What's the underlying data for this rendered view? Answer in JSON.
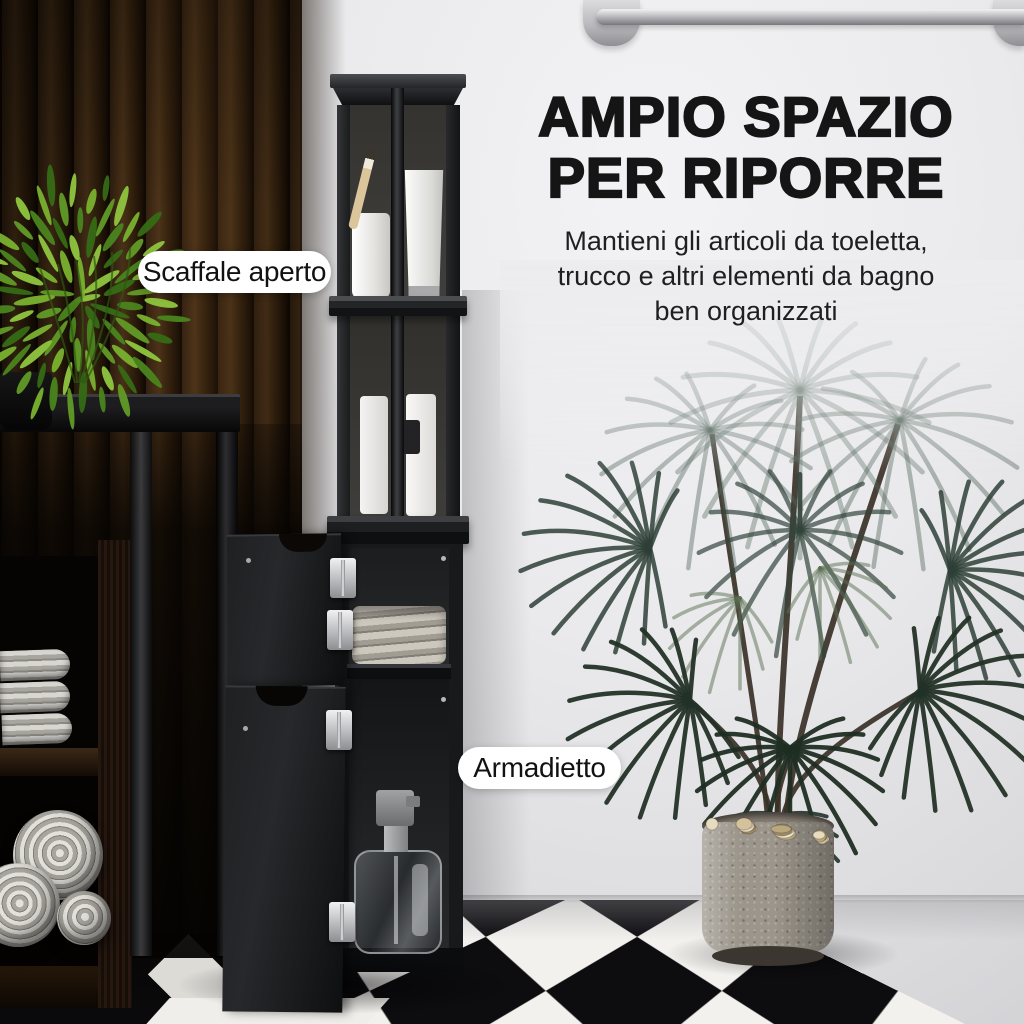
{
  "headline": {
    "line1": "AMPIO SPAZIO",
    "line2": "PER RIPORRE"
  },
  "subheadline": {
    "lines": [
      "Mantieni gli articoli da toeletta,",
      "trucco e altri elementi da bagno",
      "ben organizzati"
    ]
  },
  "callouts": {
    "open_shelf": "Scaffale aperto",
    "cabinet": "Armadietto"
  },
  "palette": {
    "headline_text": "#151515",
    "body_text": "#1f1f1f",
    "callout_bg": "#ffffff",
    "callout_text": "#121212",
    "cabinet_black": "#17191b",
    "wood_wall_brown": "#31200f",
    "wall_gray": "#eaeaec",
    "bush_green": "#79b02f",
    "palm_green": "#2e3f36",
    "floor_black": "#0d0d10",
    "floor_white": "#f2f1ee",
    "metal_silver": "#c3c3c7",
    "pot_stone": "#9b958b",
    "pebble_beige": "#e8dcc0"
  }
}
